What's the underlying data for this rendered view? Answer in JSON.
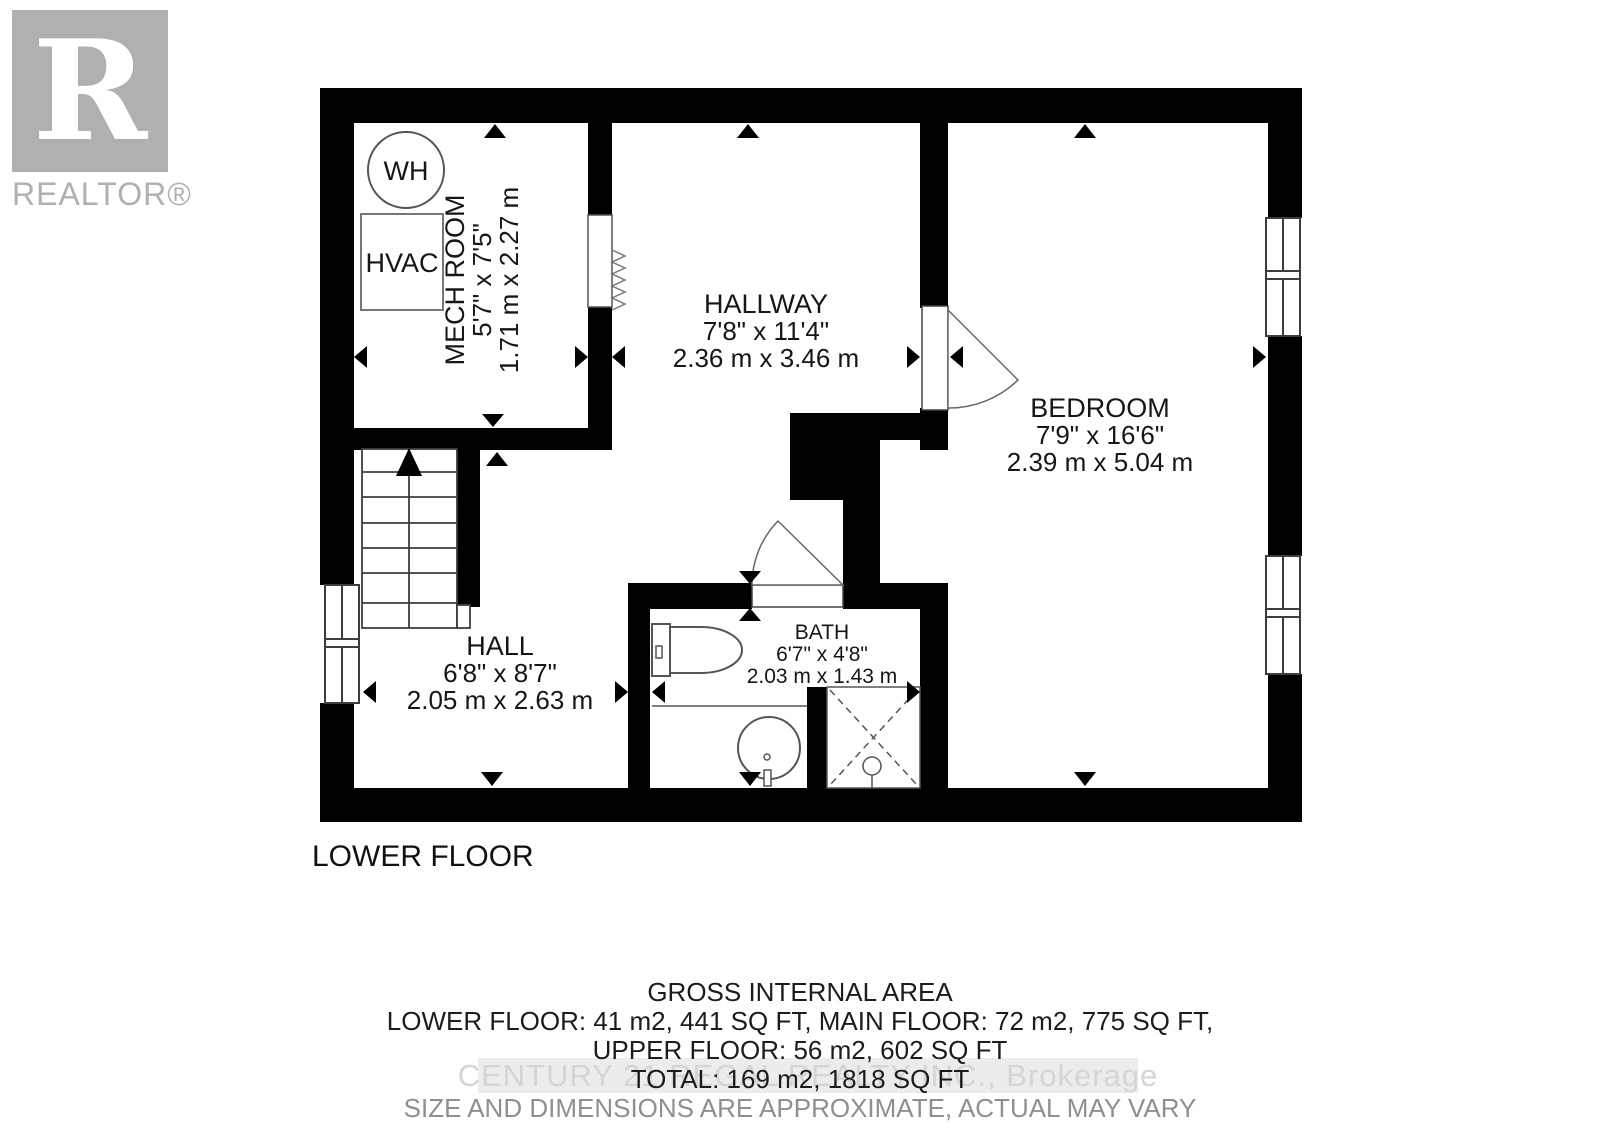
{
  "logo": {
    "letter": "R",
    "label": "REALTOR®"
  },
  "plan": {
    "floor_label": "LOWER FLOOR",
    "fixtures": {
      "water_heater": "WH",
      "hvac": "HVAC"
    },
    "rooms": [
      {
        "name": "MECH ROOM",
        "imperial": "5'7\" x 7'5\"",
        "metric": "1.71 m x 2.27 m"
      },
      {
        "name": "HALLWAY",
        "imperial": "7'8\" x 11'4\"",
        "metric": "2.36 m x 3.46 m"
      },
      {
        "name": "BEDROOM",
        "imperial": "7'9\" x 16'6\"",
        "metric": "2.39 m x 5.04 m"
      },
      {
        "name": "HALL",
        "imperial": "6'8\" x 8'7\"",
        "metric": "2.05 m x 2.63 m"
      },
      {
        "name": "BATH",
        "imperial": "6'7\" x 4'8\"",
        "metric": "2.03 m x 1.43 m"
      }
    ]
  },
  "footer": {
    "title": "GROSS INTERNAL AREA",
    "line1": "LOWER FLOOR: 41 m2, 441 SQ FT, MAIN FLOOR: 72 m2, 775 SQ FT,",
    "line2": "UPPER FLOOR: 56 m2, 602 SQ FT",
    "line3": "TOTAL: 169 m2, 1818 SQ FT",
    "disclaimer": "SIZE AND DIMENSIONS ARE APPROXIMATE, ACTUAL MAY VARY",
    "watermark": "CENTURY 21 REGAL REALTY INC., Brokerage"
  },
  "colors": {
    "wall": "#000000",
    "line": "#4a4a4a",
    "logo_gray": "#b0b0b0"
  }
}
